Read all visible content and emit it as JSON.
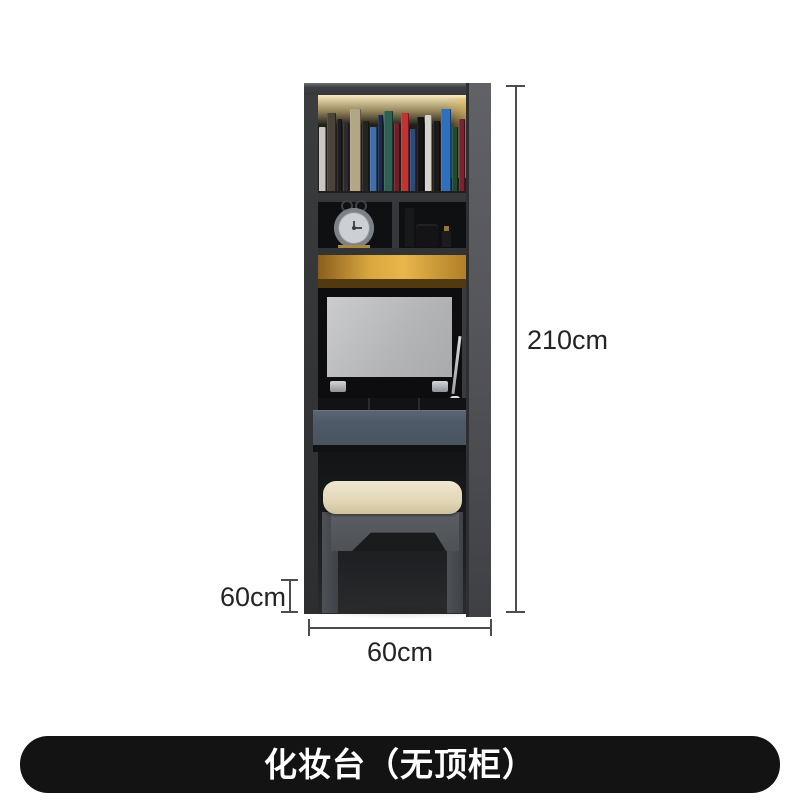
{
  "caption_banner": {
    "text": "化妆台（无顶柜）",
    "bg_color": "#131313",
    "text_color": "#ffffff"
  },
  "dimensions": {
    "total_height": "210cm",
    "stool_height": "60cm",
    "width": "60cm"
  },
  "palette": {
    "cabinet_gray": "#3a3c3e",
    "drawer_blue_gray": "#4e5a68",
    "led_gold": "#e0a83d",
    "cushion_cream": "#e8dec2",
    "mirror_gray": "#b9babc",
    "dimension_line": "#4c4c4c"
  },
  "scene_objects": [
    "bookshelf-with-led-light",
    "alarm-clock",
    "cosmetic-bottles",
    "flip-up-mirror",
    "gas-strut",
    "drawer",
    "stool-with-cushion"
  ],
  "bookshelf": {
    "books": [
      {
        "color": "#c9c7c3",
        "w": 7,
        "h": 64
      },
      {
        "color": "#4a443a",
        "w": 9,
        "h": 78
      },
      {
        "color": "#1e1e20",
        "w": 5,
        "h": 72
      },
      {
        "color": "#2c2c2e",
        "w": 6,
        "h": 68
      },
      {
        "color": "#b3a684",
        "w": 11,
        "h": 82
      },
      {
        "color": "#242422",
        "w": 7,
        "h": 70
      },
      {
        "color": "#3f6fa8",
        "w": 7,
        "h": 64
      },
      {
        "color": "#1d2a4a",
        "w": 5,
        "h": 76
      },
      {
        "color": "#2f6054",
        "w": 9,
        "h": 80
      },
      {
        "color": "#6e2026",
        "w": 6,
        "h": 68
      },
      {
        "color": "#c13434",
        "w": 8,
        "h": 78
      },
      {
        "color": "#2b4a7c",
        "w": 6,
        "h": 62
      },
      {
        "color": "#141416",
        "w": 7,
        "h": 74
      },
      {
        "color": "#d6d3cc",
        "w": 7,
        "h": 76
      },
      {
        "color": "#1a1a1c",
        "w": 7,
        "h": 70
      },
      {
        "color": "#2f6fc0",
        "w": 10,
        "h": 82
      },
      {
        "color": "#1d4a33",
        "w": 6,
        "h": 64
      },
      {
        "color": "#7a2230",
        "w": 6,
        "h": 72
      }
    ]
  }
}
